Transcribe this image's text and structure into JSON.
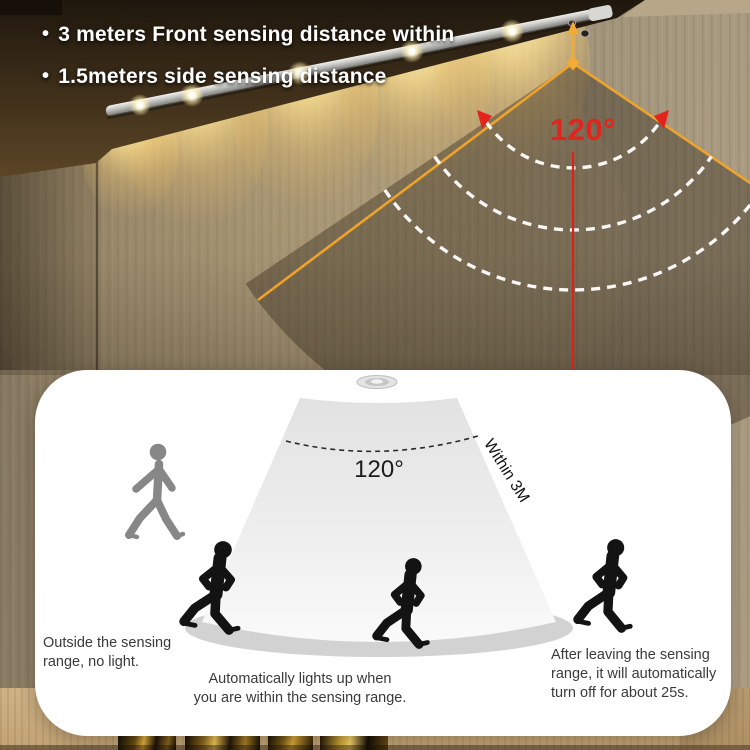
{
  "header": {
    "bullet_glyph": "•",
    "bullets": [
      {
        "label": "3 meters Front sensing distance within"
      },
      {
        "label": "1.5meters side sensing distance"
      }
    ]
  },
  "fan": {
    "angle_label": "120°"
  },
  "panel": {
    "angle_label": "120°",
    "within_label": "Within 3M",
    "caption_left": {
      "line1": "Outside the sensing",
      "line2": "range, no light."
    },
    "caption_center": {
      "line1": "Automatically lights up when",
      "line2": "you are within the sensing range."
    },
    "caption_right": {
      "line1": "After leaving the sensing",
      "line2": "range, it will automatically",
      "line3": "turn off for about 25s."
    }
  },
  "colors": {
    "accent_orange": "#efa32b",
    "accent_red": "#e3231c",
    "led_warm_glow": "#fbdf8f",
    "panel_bg": "#ffffff",
    "wall": "#9c8e75",
    "ceiling": "#3a2c18"
  }
}
